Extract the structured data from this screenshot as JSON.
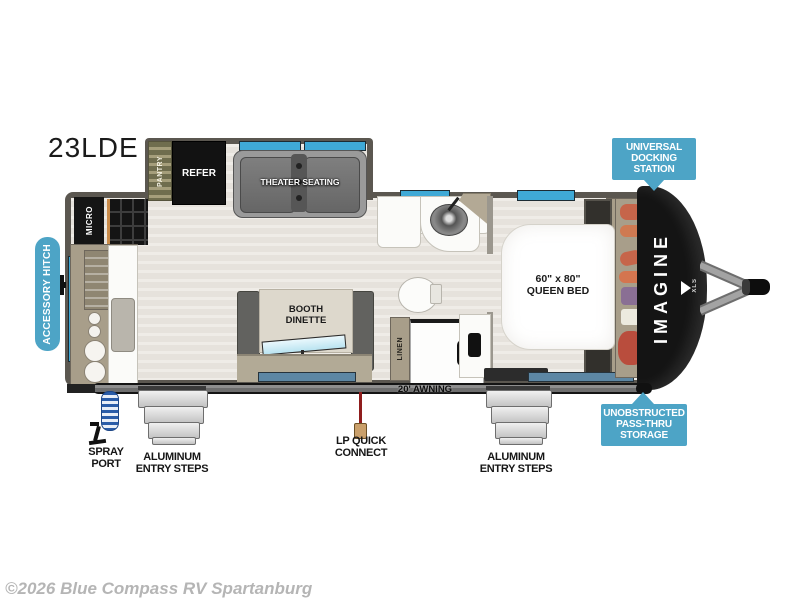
{
  "title": "23LDE",
  "copyright": "©2026 Blue Compass RV Spartanburg",
  "brand": {
    "wordmark": "IMAGINE",
    "sub": "XLS"
  },
  "colors": {
    "callout_blue": "#4da4c6",
    "window_blue": "#3fa9d6",
    "wall_gray": "#5b5750",
    "floor_beige": "#eae7e2",
    "front_cap_black": "#141414",
    "lp_line_red": "#8f1d1d"
  },
  "labels": {
    "pantry": "PANTRY",
    "refer": "REFER",
    "theater": "THEATER SEATING",
    "micro": "MICRO",
    "booth": [
      "BOOTH",
      "DINETTE"
    ],
    "linen": "LINEN",
    "bed": [
      "60\" x 80\"",
      "QUEEN BED"
    ],
    "awning": "20' AWNING"
  },
  "callouts": {
    "accessory_hitch": "ACCESSORY HITCH",
    "docking_station": [
      "UNIVERSAL",
      "DOCKING",
      "STATION"
    ],
    "pass_thru": [
      "UNOBSTRUCTED",
      "PASS-THRU",
      "STORAGE"
    ]
  },
  "annotations": {
    "spray_port": [
      "SPRAY",
      "PORT"
    ],
    "entry_steps_left": [
      "ALUMINUM",
      "ENTRY STEPS"
    ],
    "lp_quick_connect": [
      "LP QUICK",
      "CONNECT"
    ],
    "entry_steps_right": [
      "ALUMINUM",
      "ENTRY STEPS"
    ]
  }
}
